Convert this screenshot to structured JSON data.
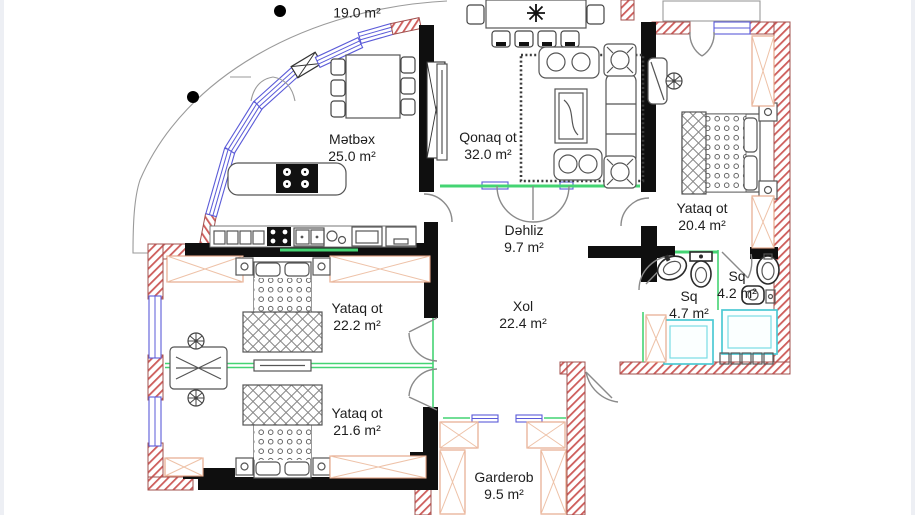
{
  "plan": {
    "type": "apartment-floor-plan",
    "colors": {
      "wall": "#0f0f0f",
      "load_bearing_hatch": "#cd5c5a",
      "window": "#5b5bd8",
      "threshold": "#44d473",
      "wardrobe": "#e3a183",
      "bathtub": "#4cc9d4",
      "furniture": "#555555"
    },
    "rooms": [
      {
        "id": "balcony",
        "name": "",
        "area": "19.0 m²"
      },
      {
        "id": "kitchen",
        "name": "Mətbəx",
        "area": "25.0 m²"
      },
      {
        "id": "living-room",
        "name": "Qonaq ot",
        "area": "32.0 m²"
      },
      {
        "id": "bedroom-east",
        "name": "Yataq ot",
        "area": "20.4 m²"
      },
      {
        "id": "hallway",
        "name": "Dəhliz",
        "area": "9.7 m²"
      },
      {
        "id": "bedroom-west",
        "name": "Yataq ot",
        "area": "22.2 m²"
      },
      {
        "id": "hall",
        "name": "Xol",
        "area": "22.4 m²"
      },
      {
        "id": "bathroom-large",
        "name": "Sq",
        "area": "4.7 m²"
      },
      {
        "id": "bathroom-small",
        "name": "Sq",
        "area": "4.2 m²"
      },
      {
        "id": "bedroom-south",
        "name": "Yataq ot",
        "area": "21.6 m²"
      },
      {
        "id": "wardrobe-room",
        "name": "Garderob",
        "area": "9.5 m²"
      }
    ]
  }
}
